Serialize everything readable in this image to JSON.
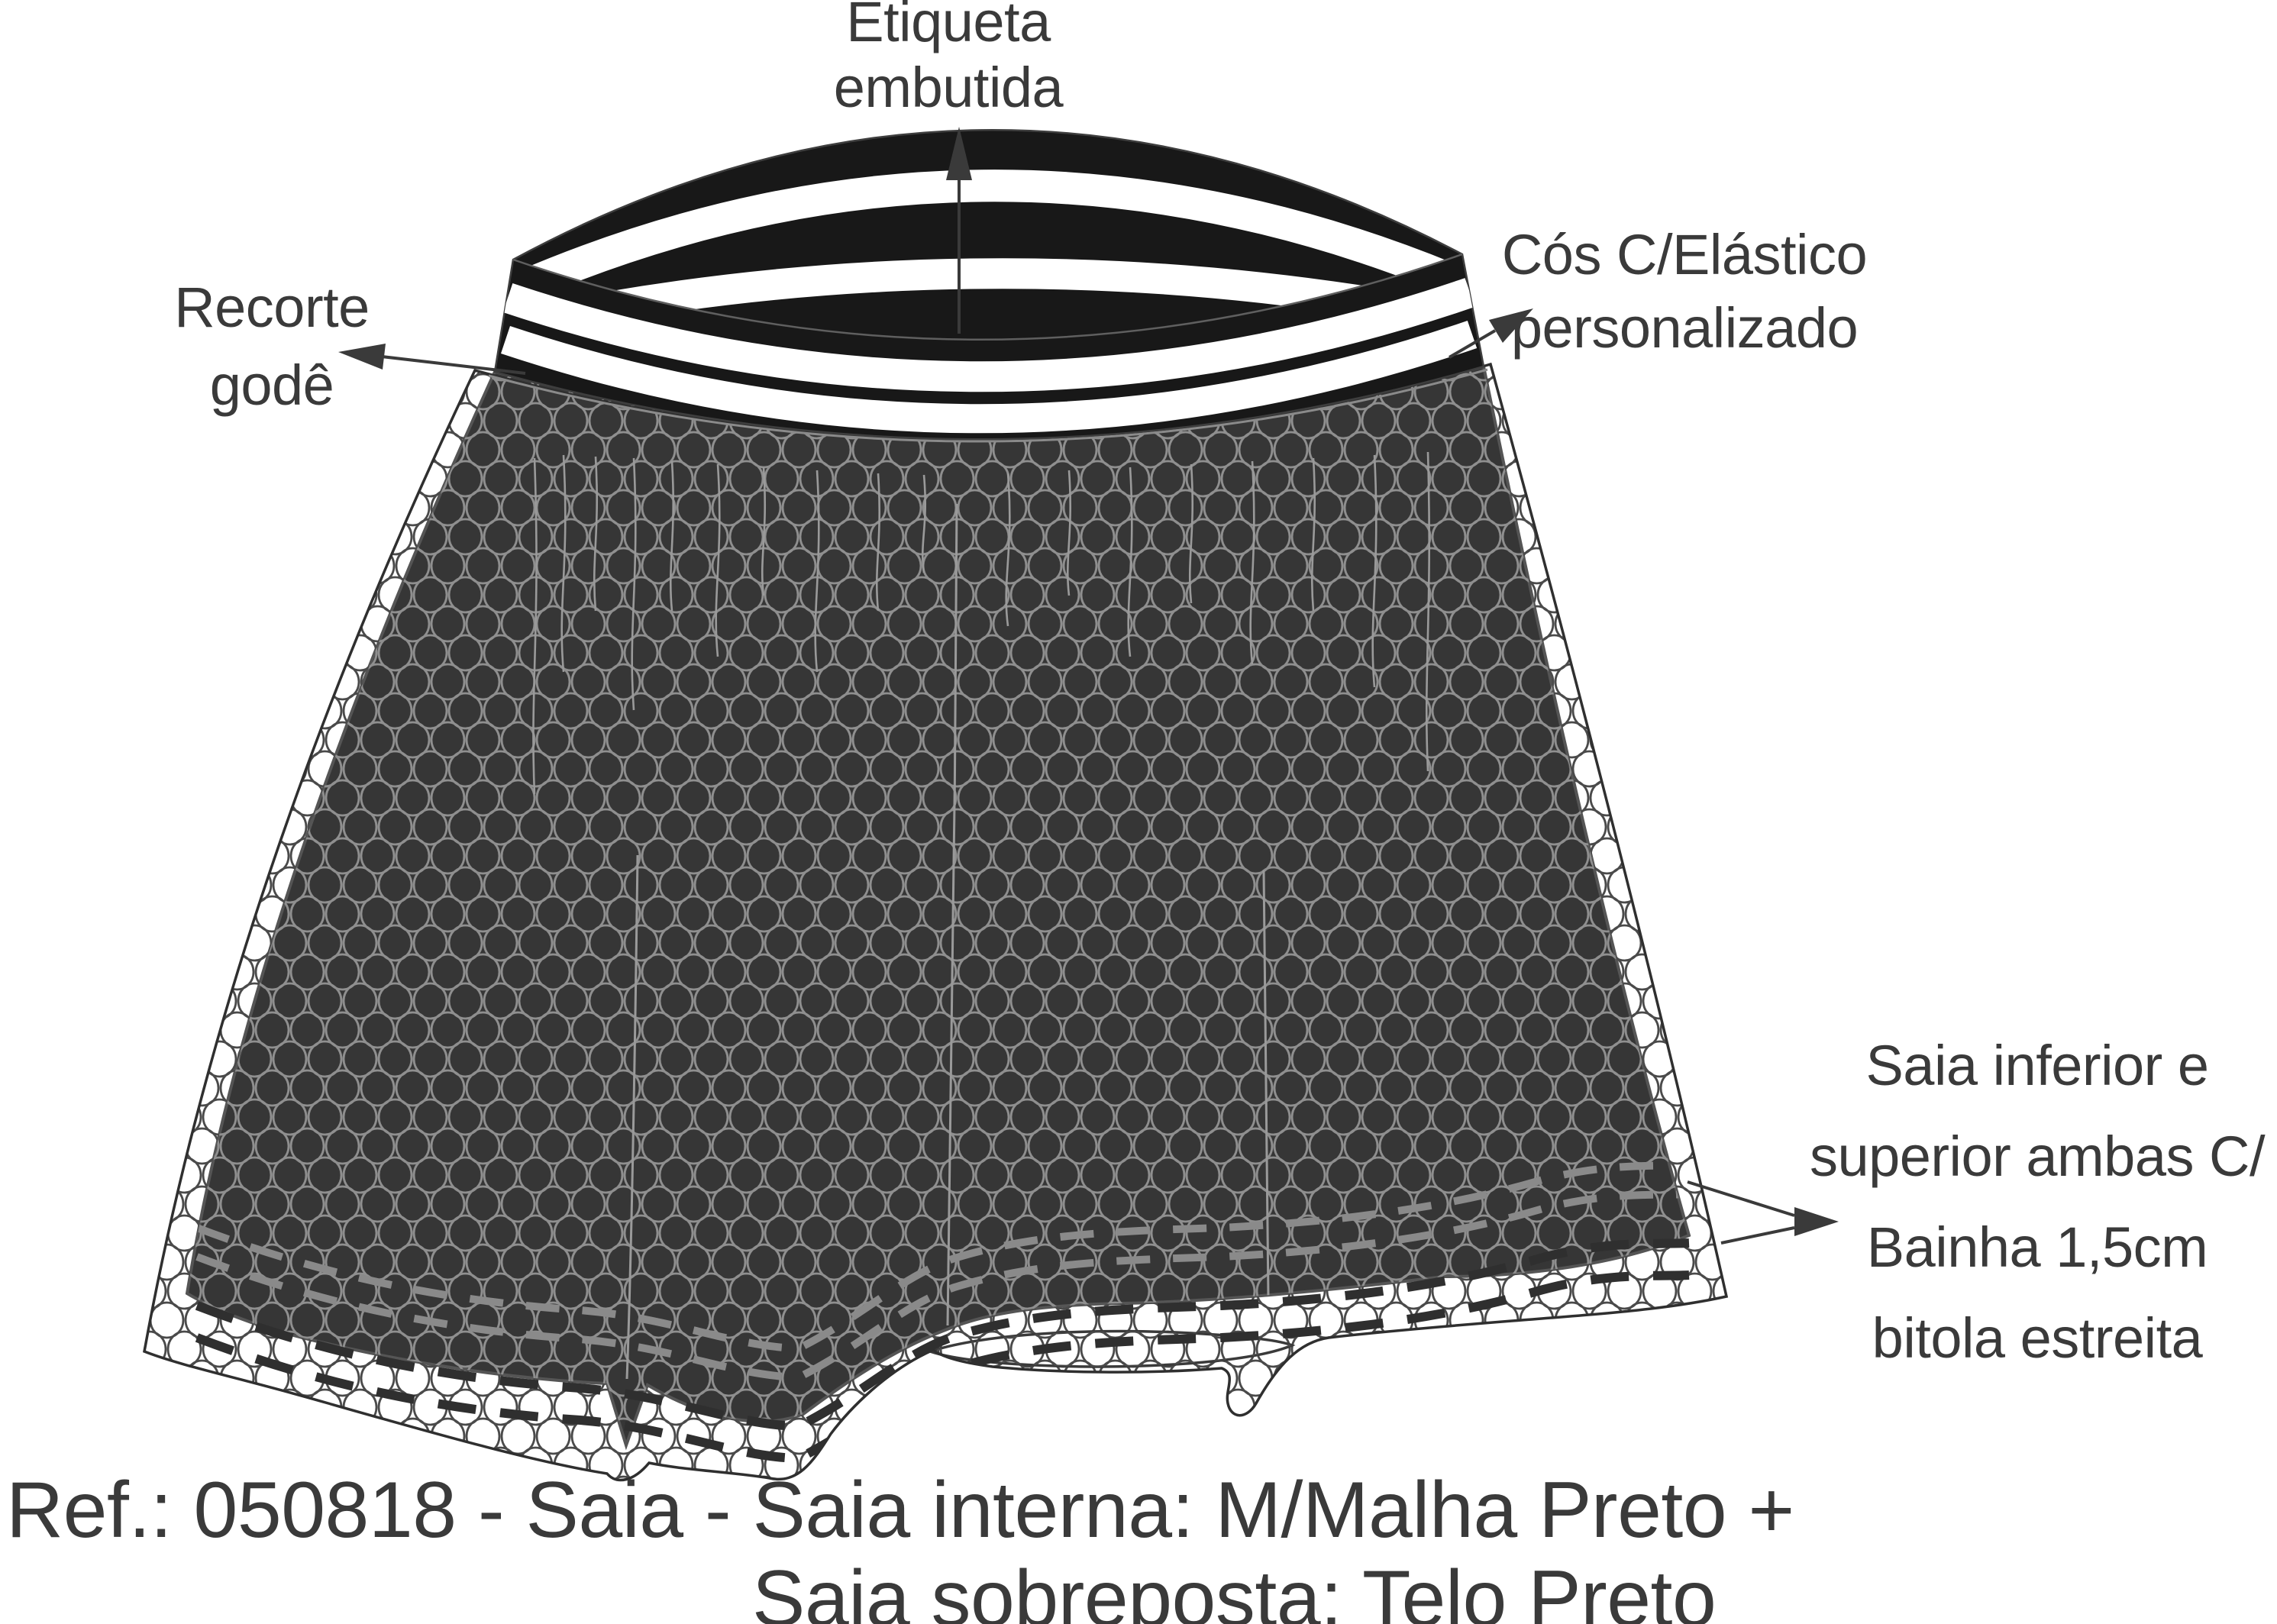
{
  "drawing": {
    "type": "fashion-technical-flat",
    "garment": "saia (skirt)",
    "callouts": {
      "label_top": "Etiqueta\nembutida",
      "label_left": "Recorte\ngodê",
      "label_right": "Cós C/Elástico\npersonalizado",
      "label_hem": "Saia inferior e\nsuperior ambas C/\nBainha 1,5cm\nbitola estreita"
    },
    "caption": {
      "line1": "Ref.: 050818 - Saia - Saia interna: M/Malha Preto +",
      "line2": "Saia sobreposta: Telo Preto"
    },
    "icons": {
      "pointer_arrows": "solid triangular arrowheads on thin leader lines"
    },
    "colors": {
      "ink": "#3a3a3a",
      "band_black": "#181818",
      "skirt_dark": "#363636",
      "mesh_light": "#8f8f8f",
      "mesh_dark": "#4a4a4a",
      "stitch_gray": "#8a8a8a",
      "stitch_dark": "#2f2f2f",
      "paper": "#ffffff"
    }
  }
}
